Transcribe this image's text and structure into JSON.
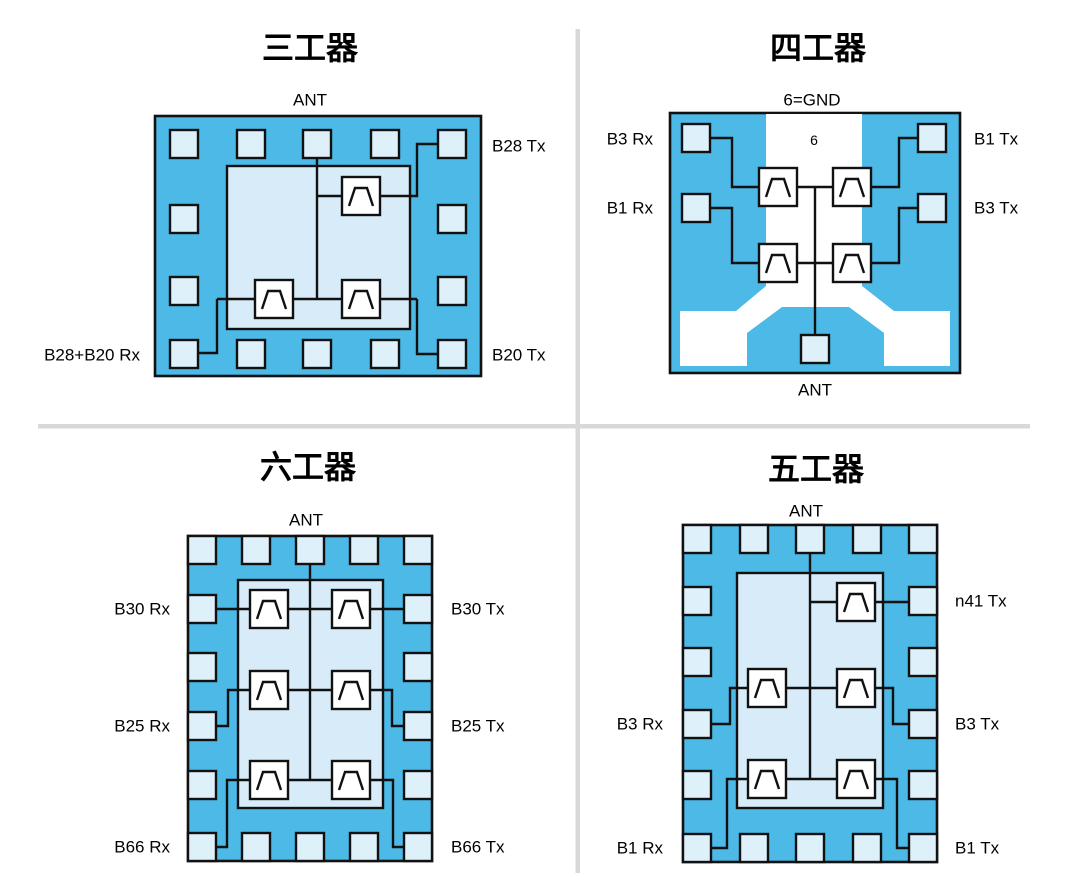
{
  "colors": {
    "chip_blue": "#4DB9E7",
    "pad_fill": "#DEF0FA",
    "inner_fill": "#D7ECF8",
    "line": "#111111",
    "ground_white": "#FFFFFF",
    "divider": "#D8D8DA",
    "text": "#000000",
    "background": "#FFFFFF"
  },
  "panels": {
    "triplexer": {
      "title": "三工器",
      "ant_label": "ANT",
      "labels": {
        "right_top": "B28 Tx",
        "right_bottom": "B20 Tx",
        "left_bottom": "B28+B20 Rx"
      }
    },
    "quadplexer": {
      "title": "四工器",
      "gnd_label": "6=GND",
      "gnd_pin": "6",
      "ant_label": "ANT",
      "labels": {
        "left_top": "B3 Rx",
        "left_mid": "B1 Rx",
        "right_top": "B1 Tx",
        "right_mid": "B3 Tx"
      }
    },
    "hexaplexer": {
      "title": "六工器",
      "ant_label": "ANT",
      "labels": {
        "left_1": "B30 Rx",
        "left_2": "B25 Rx",
        "left_3": "B66 Rx",
        "right_1": "B30 Tx",
        "right_2": "B25 Tx",
        "right_3": "B66 Tx"
      }
    },
    "pentaplexer": {
      "title": "五工器",
      "ant_label": "ANT",
      "labels": {
        "right_1": "n41 Tx",
        "left_2": "B3 Rx",
        "right_2": "B3 Tx",
        "left_3": "B1 Rx",
        "right_3": "B1 Tx"
      }
    }
  }
}
